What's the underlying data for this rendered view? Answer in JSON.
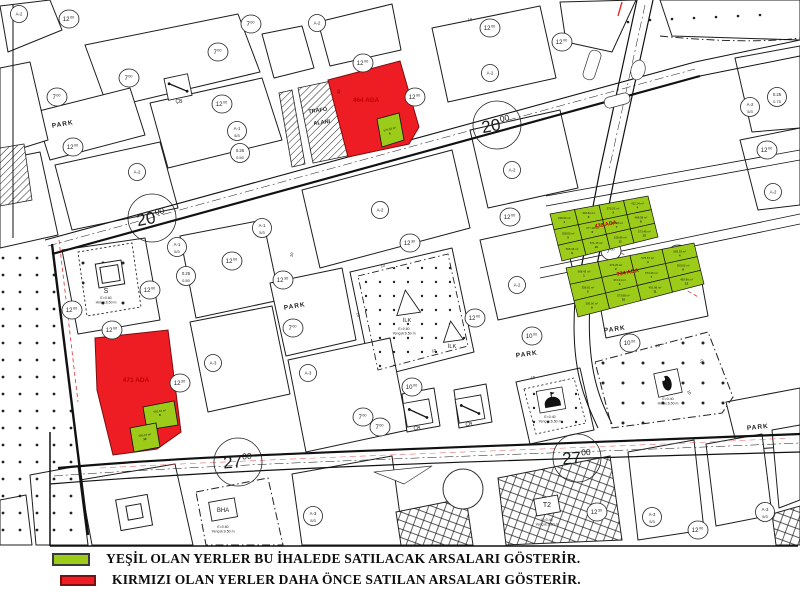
{
  "legend": {
    "items": [
      {
        "color": "#9ccb19",
        "text": "YEŞİL OLAN YERLER BU İHALEDE SATILACAK ARSALARI GÖSTERİR."
      },
      {
        "color": "#ee1c23",
        "text": "KIRMIZI OLAN YERLER DAHA ÖNCE SATILAN ARSALARI GÖSTERİR."
      }
    ]
  },
  "map": {
    "colors": {
      "green": "#9ccb19",
      "red": "#ee1c23",
      "ada_text": "#c00000",
      "line": "#1d1d1d"
    },
    "park_text": "PARK",
    "ilk_text": "İLK",
    "cb_text": "ÇB",
    "s_text": "S",
    "bha_text": "BHA",
    "t2_text": "T2",
    "trafo": {
      "l1": "TRAFO",
      "l2": "ALANI",
      "x": 318,
      "y": 112
    },
    "big_labels": [
      {
        "x": 152,
        "y": 218,
        "rot": -11,
        "main": "20",
        "sup": "00"
      },
      {
        "x": 497,
        "y": 125,
        "rot": -11,
        "main": "20",
        "sup": "00"
      },
      {
        "x": 238,
        "y": 462,
        "rot": -4,
        "main": "27",
        "sup": "00"
      },
      {
        "x": 577,
        "y": 458,
        "rot": -4,
        "main": "27",
        "sup": "00"
      }
    ],
    "road_circles": [
      {
        "x": 69,
        "y": 19,
        "main": "12",
        "sup": "00"
      },
      {
        "x": 222,
        "y": 104,
        "main": "12",
        "sup": "00"
      },
      {
        "x": 73,
        "y": 147,
        "main": "12",
        "sup": "00"
      },
      {
        "x": 490,
        "y": 28,
        "main": "12",
        "sup": "00"
      },
      {
        "x": 363,
        "y": 63,
        "main": "12",
        "sup": "00"
      },
      {
        "x": 415,
        "y": 97,
        "main": "12",
        "sup": "00"
      },
      {
        "x": 562,
        "y": 42,
        "main": "12",
        "sup": "00"
      },
      {
        "x": 767,
        "y": 150,
        "main": "12",
        "sup": "00"
      },
      {
        "x": 232,
        "y": 261,
        "main": "12",
        "sup": "00"
      },
      {
        "x": 150,
        "y": 290,
        "main": "12",
        "sup": "00"
      },
      {
        "x": 72,
        "y": 310,
        "main": "12",
        "sup": "00"
      },
      {
        "x": 112,
        "y": 330,
        "main": "12",
        "sup": "00"
      },
      {
        "x": 510,
        "y": 217,
        "main": "12",
        "sup": "00"
      },
      {
        "x": 475,
        "y": 318,
        "main": "12",
        "sup": "00"
      },
      {
        "x": 678,
        "y": 254,
        "main": "12",
        "sup": "00"
      },
      {
        "x": 698,
        "y": 530,
        "main": "12",
        "sup": "00"
      },
      {
        "x": 251,
        "y": 24,
        "main": "7",
        "sup": "00"
      },
      {
        "x": 218,
        "y": 52,
        "main": "7",
        "sup": "00"
      },
      {
        "x": 129,
        "y": 78,
        "main": "7",
        "sup": "00"
      },
      {
        "x": 57,
        "y": 97,
        "main": "7",
        "sup": "00"
      },
      {
        "x": 293,
        "y": 328,
        "main": "7",
        "sup": "00"
      },
      {
        "x": 363,
        "y": 417,
        "main": "7",
        "sup": "00"
      },
      {
        "x": 380,
        "y": 427,
        "main": "7",
        "sup": "00"
      },
      {
        "x": 611,
        "y": 251,
        "main": "7",
        "sup": "00"
      },
      {
        "x": 532,
        "y": 336,
        "main": "10",
        "sup": "00"
      },
      {
        "x": 412,
        "y": 387,
        "main": "10",
        "sup": "00"
      },
      {
        "x": 630,
        "y": 343,
        "main": "10",
        "sup": "00"
      },
      {
        "x": 410,
        "y": 243,
        "main": "12",
        "sup": "30"
      },
      {
        "x": 283,
        "y": 280,
        "main": "12",
        "sup": "30"
      },
      {
        "x": 180,
        "y": 383,
        "main": "12",
        "sup": "30"
      },
      {
        "x": 597,
        "y": 512,
        "main": "12",
        "sup": "30"
      }
    ],
    "zone_circles": [
      {
        "x": 19,
        "y": 14,
        "l1": "A-2"
      },
      {
        "x": 317,
        "y": 23,
        "l1": "A-2"
      },
      {
        "x": 137,
        "y": 172,
        "l1": "A-2"
      },
      {
        "x": 490,
        "y": 73,
        "l1": "A-2"
      },
      {
        "x": 512,
        "y": 170,
        "l1": "A-2"
      },
      {
        "x": 380,
        "y": 210,
        "l1": "A-2"
      },
      {
        "x": 517,
        "y": 285,
        "l1": "A-2"
      },
      {
        "x": 773,
        "y": 192,
        "l1": "A-2"
      },
      {
        "x": 750,
        "y": 107,
        "l1": "A-2",
        "l2": "5/3"
      },
      {
        "x": 777,
        "y": 97,
        "l1": "0.25",
        "l2": "0.75"
      },
      {
        "x": 240,
        "y": 153,
        "l1": "0.25",
        "l2": "0.50"
      },
      {
        "x": 186,
        "y": 276,
        "l1": "0.25",
        "l2": "0.50"
      },
      {
        "x": 237,
        "y": 131,
        "l1": "A-1",
        "l2": "5/3"
      },
      {
        "x": 177,
        "y": 247,
        "l1": "A-1",
        "l2": "5/3"
      },
      {
        "x": 262,
        "y": 228,
        "l1": "A-1",
        "l2": "5/3"
      },
      {
        "x": 213,
        "y": 363,
        "l1": "A-3"
      },
      {
        "x": 308,
        "y": 373,
        "l1": "A-3"
      },
      {
        "x": 313,
        "y": 516,
        "l1": "A-3",
        "l2": "5/3"
      },
      {
        "x": 652,
        "y": 517,
        "l1": "A-3",
        "l2": "5/3"
      },
      {
        "x": 765,
        "y": 512,
        "l1": "A-3",
        "l2": "5/3"
      }
    ],
    "park_labels": [
      {
        "x": 63,
        "y": 126,
        "rot": -10
      },
      {
        "x": 295,
        "y": 308,
        "rot": -10
      },
      {
        "x": 527,
        "y": 356,
        "rot": -8
      },
      {
        "x": 615,
        "y": 331,
        "rot": -8
      },
      {
        "x": 758,
        "y": 429,
        "rot": -6
      }
    ],
    "ilk_labels": [
      {
        "x": 407,
        "y": 322
      },
      {
        "x": 452,
        "y": 348
      }
    ],
    "cb_labels": [
      {
        "x": 179,
        "y": 103
      },
      {
        "x": 417,
        "y": 430
      },
      {
        "x": 469,
        "y": 426
      }
    ],
    "s_label": {
      "x": 106,
      "y": 293
    },
    "bha_label": {
      "x": 223,
      "y": 512
    },
    "t2_label": {
      "x": 547,
      "y": 507
    },
    "ada_labels": [
      {
        "x": 366,
        "y": 102,
        "text": "464 ADA",
        "size": 6.5,
        "rot": 0
      },
      {
        "x": 136,
        "y": 382,
        "text": "471 ADA",
        "size": 6.5,
        "rot": 0
      },
      {
        "x": 606,
        "y": 226,
        "text": "438 ADA",
        "size": 5.5,
        "rot": -11
      },
      {
        "x": 628,
        "y": 274,
        "text": "734 ADA",
        "size": 5.5,
        "rot": -11
      }
    ],
    "green_block_a": {
      "quad": [
        [
          550,
          214
        ],
        [
          648,
          196
        ],
        [
          658,
          237
        ],
        [
          562,
          261
        ]
      ],
      "cols": 4,
      "rows": 3,
      "parcels": [
        {
          "area": "338.80 m²",
          "no": "1"
        },
        {
          "area": "334.81 m²",
          "no": "2"
        },
        {
          "area": "575.53 m²",
          "no": "3"
        },
        {
          "area": "412.14 m²",
          "no": "4"
        },
        {
          "area": "358.80 m²",
          "no": "5"
        },
        {
          "area": "377.18 m²",
          "no": "6"
        },
        {
          "area": "336.48 m²",
          "no": "7"
        },
        {
          "area": "468.58 m²",
          "no": "8"
        },
        {
          "area": "565.46 m²",
          "no": "9"
        },
        {
          "area": "571.15 m²",
          "no": "10"
        },
        {
          "area": "538.89 m²",
          "no": "11"
        },
        {
          "area": "573.46 m²",
          "no": "12"
        }
      ]
    },
    "green_block_b": {
      "quad": [
        [
          566,
          268
        ],
        [
          694,
          243
        ],
        [
          704,
          284
        ],
        [
          578,
          317
        ]
      ],
      "cols": 4,
      "rows": 3,
      "parcels": [
        {
          "area": "368.43 m²",
          "no": "1"
        },
        {
          "area": "374.25 m²",
          "no": "2"
        },
        {
          "area": "575.57 m²",
          "no": "3"
        },
        {
          "area": "565.53 m²",
          "no": "4"
        },
        {
          "area": "358.81 m²",
          "no": "5"
        },
        {
          "area": "374.21 m²",
          "no": "6"
        },
        {
          "area": "573.46 m²",
          "no": "7"
        },
        {
          "area": "500.82 m²",
          "no": "8"
        },
        {
          "area": "350.90 m²",
          "no": "9"
        },
        {
          "area": "573.88 m²",
          "no": "10"
        },
        {
          "area": "451.96 m²",
          "no": "11"
        },
        {
          "area": "450.96 m²",
          "no": "12"
        }
      ]
    },
    "red_block_green_parcels": [
      {
        "area": "593.53 m²",
        "no": "8",
        "x": 160,
        "y": 412,
        "rot": -8
      },
      {
        "area": "580.16 m²",
        "no": "12",
        "x": 145,
        "y": 436,
        "rot": -8
      }
    ],
    "parcel_464": {
      "area": "575.53 m²",
      "no": "4",
      "x": 390,
      "y": 130,
      "rot": -14
    },
    "notes": [
      {
        "x": 106,
        "y": 299,
        "l1": "E=0.60",
        "l2": "Hmax:6.50 m"
      },
      {
        "x": 404,
        "y": 330,
        "l1": "E=0.60",
        "l2": "Yençok:6.50 m"
      },
      {
        "x": 550,
        "y": 418,
        "l1": "E=0.40",
        "l2": "Yençok:6.50 m"
      },
      {
        "x": 668,
        "y": 400,
        "l1": "E=0.40",
        "l2": "Hmax:6.50 m"
      },
      {
        "x": 223,
        "y": 528,
        "l1": "E=0.60",
        "l2": "Yençok:9.50 m"
      },
      {
        "x": 547,
        "y": 521,
        "l1": "E=0.40",
        "l2": "Yençok:6.50 m"
      }
    ],
    "ten_marks": [
      {
        "x": 383,
        "y": 267,
        "rot": -12,
        "t": "10"
      },
      {
        "x": 470,
        "y": 21,
        "rot": -6,
        "t": "10"
      },
      {
        "x": 533,
        "y": 379,
        "rot": -10,
        "t": "10"
      },
      {
        "x": 658,
        "y": 347,
        "rot": -13,
        "t": "10"
      },
      {
        "x": 688,
        "y": 393,
        "rot": 58,
        "t": "10"
      },
      {
        "x": 357,
        "y": 315,
        "rot": 75,
        "t": "10"
      },
      {
        "x": 434,
        "y": 352,
        "rot": -12,
        "t": "10"
      },
      {
        "x": 703,
        "y": 362,
        "rot": -75,
        "t": "10"
      },
      {
        "x": 340,
        "y": 92,
        "rot": -78,
        "t": "10"
      },
      {
        "x": 293,
        "y": 255,
        "rot": -80,
        "t": "10"
      }
    ]
  }
}
